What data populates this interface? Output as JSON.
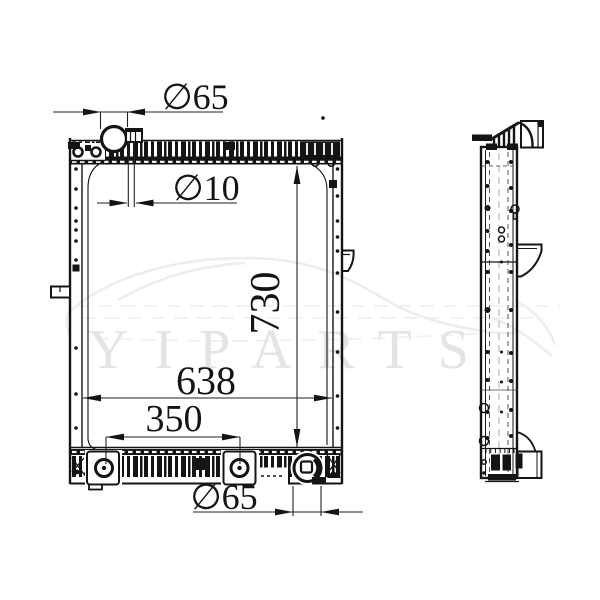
{
  "watermark": {
    "text": "YIPARTS"
  },
  "dimensions": {
    "filler_neck_diameter": "∅65",
    "overflow_tube_diameter": "∅10",
    "core_height": "730",
    "core_width": "638",
    "mounting_spacing": "350",
    "outlet_diameter": "∅65"
  },
  "colors": {
    "line": "#141414",
    "background": "#ffffff",
    "watermark": "#e4e4e4"
  }
}
